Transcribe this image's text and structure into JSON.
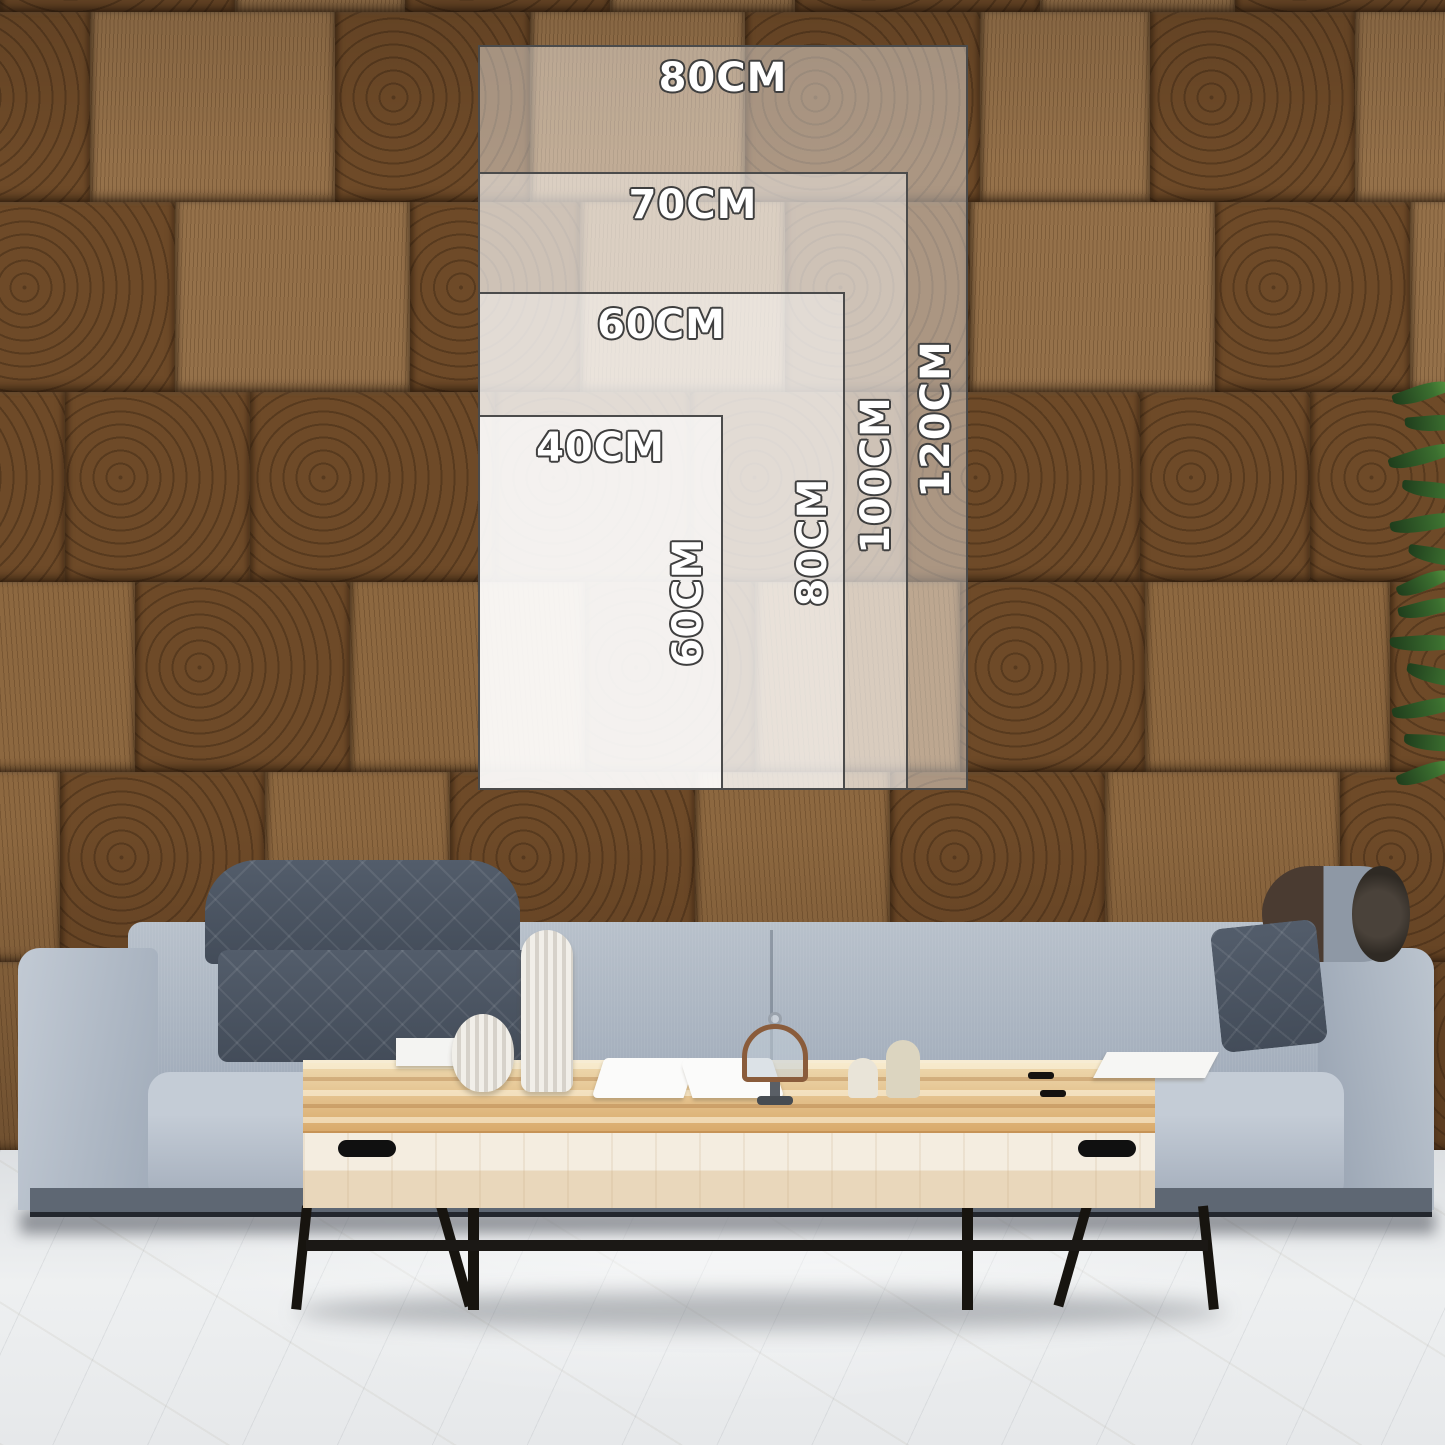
{
  "image_type": "wall-art size guide mockup",
  "size_guide": {
    "unit": "CM",
    "sizes": [
      {
        "width_label": "80CM",
        "height_label": "120CM"
      },
      {
        "width_label": "70CM",
        "height_label": "100CM"
      },
      {
        "width_label": "60CM",
        "height_label": "80CM"
      },
      {
        "width_label": "40CM",
        "height_label": "60CM"
      }
    ]
  },
  "scene": {
    "colors": {
      "wood_wall": "#6f4b29",
      "overlay_fill": "rgba(255,255,255,0.42)",
      "overlay_border": "#4b4b4b",
      "label_fill": "#ffffff",
      "label_outline": "#3f3f3f",
      "sofa_fabric": "#a6b0be",
      "sofa_headrest": "#4a5462",
      "table_wood_top": "#dcb077",
      "table_face": "#f0e7d6",
      "table_metal": "#1b1815",
      "floor": "#e8eaec",
      "plant_green": "#2f5426"
    }
  }
}
